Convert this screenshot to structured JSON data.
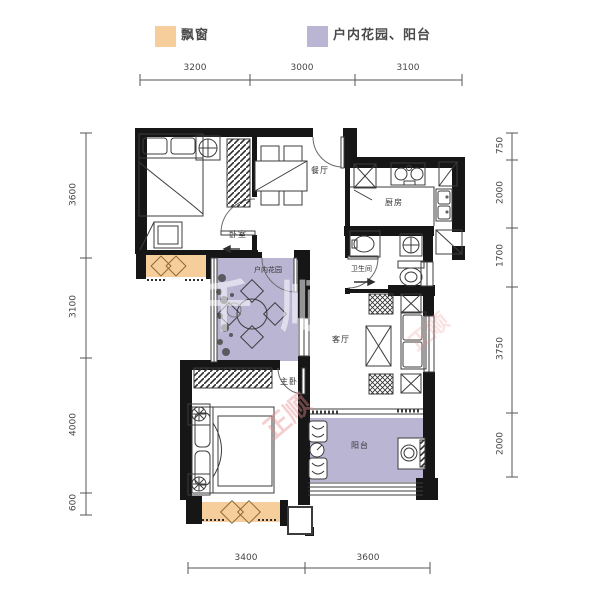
{
  "legend": {
    "items": [
      {
        "label": "飘窗",
        "color": "#F6CE9C"
      },
      {
        "label": "户内花园、阳台",
        "color": "#BBB5D4"
      }
    ]
  },
  "rooms": {
    "dining": "餐厅",
    "kitchen": "厨房",
    "bedroom": "卧室",
    "garden": "户内花园",
    "bathroom": "卫生间",
    "living": "客厅",
    "master": "主卧",
    "balcony": "阳台"
  },
  "dimensions": {
    "top": [
      "3200",
      "3000",
      "3100"
    ],
    "bottom": [
      "3400",
      "3600"
    ],
    "left": [
      "3600",
      "3100",
      "4000",
      "600"
    ],
    "right": [
      "750",
      "2000",
      "1700",
      "3750",
      "2000"
    ]
  },
  "watermarks": {
    "center": "千顺",
    "diagonal": "正顺"
  },
  "colors": {
    "bay_window": "#F6CE9C",
    "garden_balcony": "#BBB5D4",
    "wall": "#161616",
    "line": "#3c3c3c"
  }
}
